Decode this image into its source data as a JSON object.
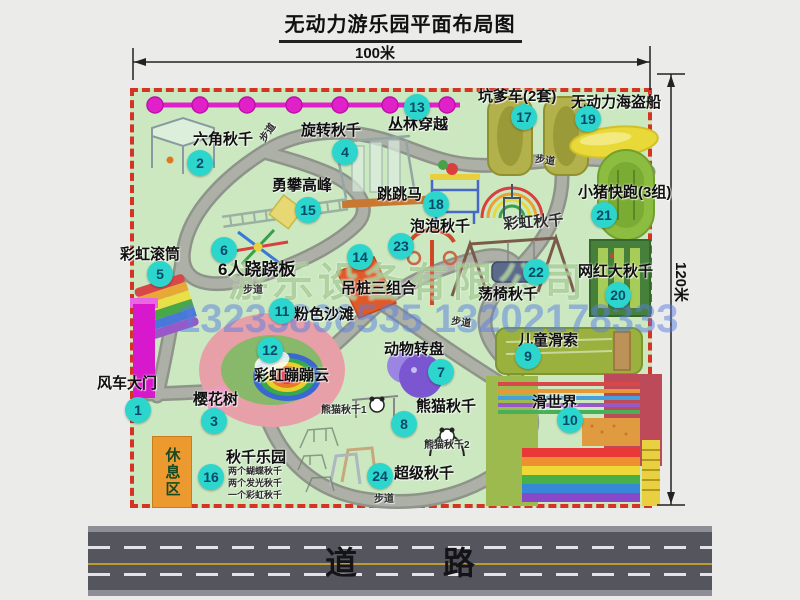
{
  "title": "无动力游乐园平面布局图",
  "dimensions": {
    "top": "100米",
    "right": "120米"
  },
  "road_label": "道 路",
  "rest_area_label": "休息区",
  "watermark": {
    "company": "游乐设备有限公司",
    "phone": "13233806535 13202178333"
  },
  "colors": {
    "park_green": "#cbe8c0",
    "border_red": "#d53425",
    "path_gray": "#a5a89f",
    "badge_cyan": "#2cd6cd",
    "badge_text": "#074a6a",
    "zipline_magenta": "#e020c8",
    "road_gray": "#55555d",
    "rest_area_orange": "#ec9a30"
  },
  "items": [
    {
      "n": "1",
      "label": "风车大门",
      "lx": 97,
      "ly": 376,
      "bx": 138,
      "by": 410
    },
    {
      "n": "2",
      "label": "六角秋千",
      "lx": 193,
      "ly": 132,
      "bx": 200,
      "by": 163
    },
    {
      "n": "3",
      "label": "樱花树",
      "lx": 193,
      "ly": 392,
      "bx": 214,
      "by": 421
    },
    {
      "n": "4",
      "label": "旋转秋千",
      "lx": 301,
      "ly": 123,
      "bx": 345,
      "by": 152
    },
    {
      "n": "5",
      "label": "彩虹滚筒",
      "lx": 120,
      "ly": 247,
      "bx": 160,
      "by": 274
    },
    {
      "n": "6",
      "label": "6人跷跷板",
      "lx": 218,
      "ly": 261,
      "bx": 224,
      "by": 250,
      "ls": 17
    },
    {
      "n": "7",
      "label": "动物转盘",
      "lx": 384,
      "ly": 342,
      "bx": 441,
      "by": 372
    },
    {
      "n": "8",
      "label": "熊猫秋千",
      "lx": 416,
      "ly": 399,
      "bx": 404,
      "by": 424
    },
    {
      "n": "9",
      "label": "儿童滑索",
      "lx": 518,
      "ly": 333,
      "bx": 528,
      "by": 356
    },
    {
      "n": "10",
      "label": "滑世界",
      "lx": 532,
      "ly": 395,
      "bx": 570,
      "by": 420
    },
    {
      "n": "11",
      "label": "粉色沙滩",
      "lx": 294,
      "ly": 307,
      "bx": 282,
      "by": 311
    },
    {
      "n": "12",
      "label": "彩虹蹦蹦云",
      "lx": 254,
      "ly": 368,
      "bx": 270,
      "by": 350
    },
    {
      "n": "13",
      "label": "丛林穿越",
      "lx": 388,
      "ly": 117,
      "bx": 417,
      "by": 107
    },
    {
      "n": "14",
      "label": "吊桩三组合",
      "lx": 341,
      "ly": 281,
      "bx": 360,
      "by": 257
    },
    {
      "n": "15",
      "label": "勇攀高峰",
      "lx": 272,
      "ly": 178,
      "bx": 308,
      "by": 210
    },
    {
      "n": "16",
      "label": "秋千乐园",
      "lx": 226,
      "ly": 450,
      "bx": 211,
      "by": 477
    },
    {
      "n": "17",
      "label": "坑爹车(2套)",
      "lx": 478,
      "ly": 89,
      "bx": 524,
      "by": 117
    },
    {
      "n": "18",
      "label": "跳跳马",
      "lx": 377,
      "ly": 187,
      "bx": 436,
      "by": 204
    },
    {
      "n": "19",
      "label": "无动力海盗船",
      "lx": 571,
      "ly": 95,
      "bx": 588,
      "by": 119
    },
    {
      "n": "20",
      "label": "网红大秋千",
      "lx": 578,
      "ly": 264,
      "bx": 618,
      "by": 295
    },
    {
      "n": "21",
      "label": "小猪快跑(3组)",
      "lx": 578,
      "ly": 185,
      "bx": 604,
      "by": 215
    },
    {
      "n": "22",
      "label": "荡椅秋千",
      "lx": 478,
      "ly": 287,
      "bx": 536,
      "by": 272
    },
    {
      "n": "23",
      "label": "泡泡秋千",
      "lx": 410,
      "ly": 219,
      "bx": 401,
      "by": 246
    },
    {
      "n": "24",
      "label": "超级秋千",
      "lx": 394,
      "ly": 466,
      "bx": 380,
      "by": 476
    }
  ],
  "extra_labels": [
    {
      "text": "彩虹秋千",
      "x": 503,
      "y": 217,
      "size": 15,
      "rot": -4
    },
    {
      "text": "熊猫秋千1",
      "x": 321,
      "y": 405,
      "size": 10,
      "rot": 0
    },
    {
      "text": "熊猫秋千2",
      "x": 424,
      "y": 440,
      "size": 10,
      "rot": 0
    },
    {
      "text": "两个蝴蝶秋千",
      "x": 228,
      "y": 467,
      "size": 9,
      "rot": 0
    },
    {
      "text": "两个发光秋千",
      "x": 228,
      "y": 479,
      "size": 9,
      "rot": 0
    },
    {
      "text": "一个彩虹秋千",
      "x": 228,
      "y": 491,
      "size": 9,
      "rot": 0
    },
    {
      "text": "步道",
      "x": 258,
      "y": 138,
      "size": 10,
      "rot": -55
    },
    {
      "text": "步道",
      "x": 536,
      "y": 154,
      "size": 10,
      "rot": 8
    },
    {
      "text": "步道",
      "x": 243,
      "y": 285,
      "size": 10,
      "rot": 0
    },
    {
      "text": "步道",
      "x": 452,
      "y": 316,
      "size": 10,
      "rot": 8
    },
    {
      "text": "步道",
      "x": 374,
      "y": 494,
      "size": 10,
      "rot": 0
    }
  ]
}
